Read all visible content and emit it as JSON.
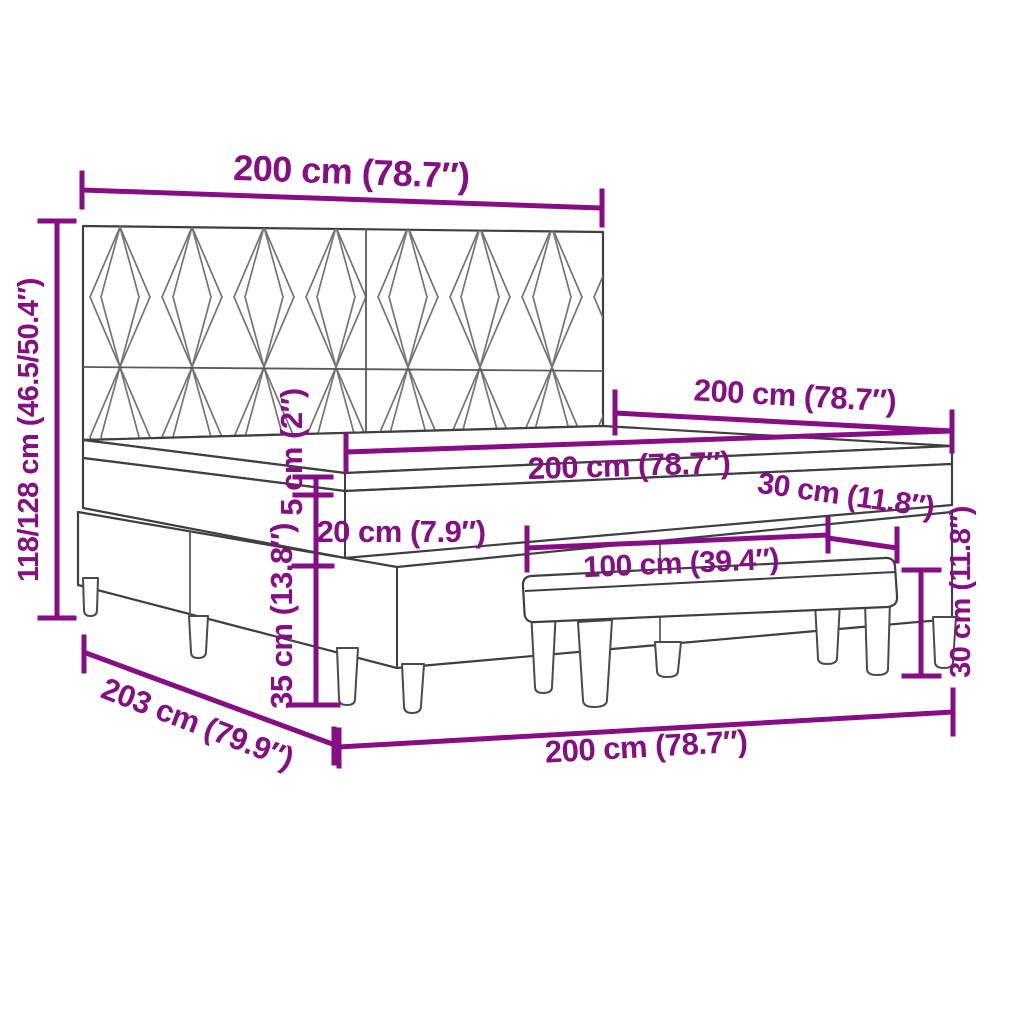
{
  "diagram": {
    "kind": "furniture-dimension-diagram",
    "subject": "box spring bed with patterned headboard, mattress, topper and bench",
    "background_color": "#ffffff",
    "accent_color": "#870d84",
    "line_color": "#3f3f3f",
    "pattern_line_color": "#757575",
    "dimensions": {
      "headboard_width": "200 cm (78.7″)",
      "bed_length_top": "200 cm (78.7″)",
      "mattress_width": "200 cm (78.7″)",
      "bed_width_bottom": "200 cm (78.7″)",
      "total_height": "118/128 cm (46.5/50.4″)",
      "topper_height": "5 cm (2″)",
      "mattress_height": "20 cm (7.9″)",
      "base_height": "35 cm (13.8″)",
      "total_length": "203 cm (79.9″)",
      "bench_length": "100 cm (39.4″)",
      "bench_end_inset": "30 cm (11.8″)",
      "bench_height": "30 cm (11.8″)"
    }
  }
}
